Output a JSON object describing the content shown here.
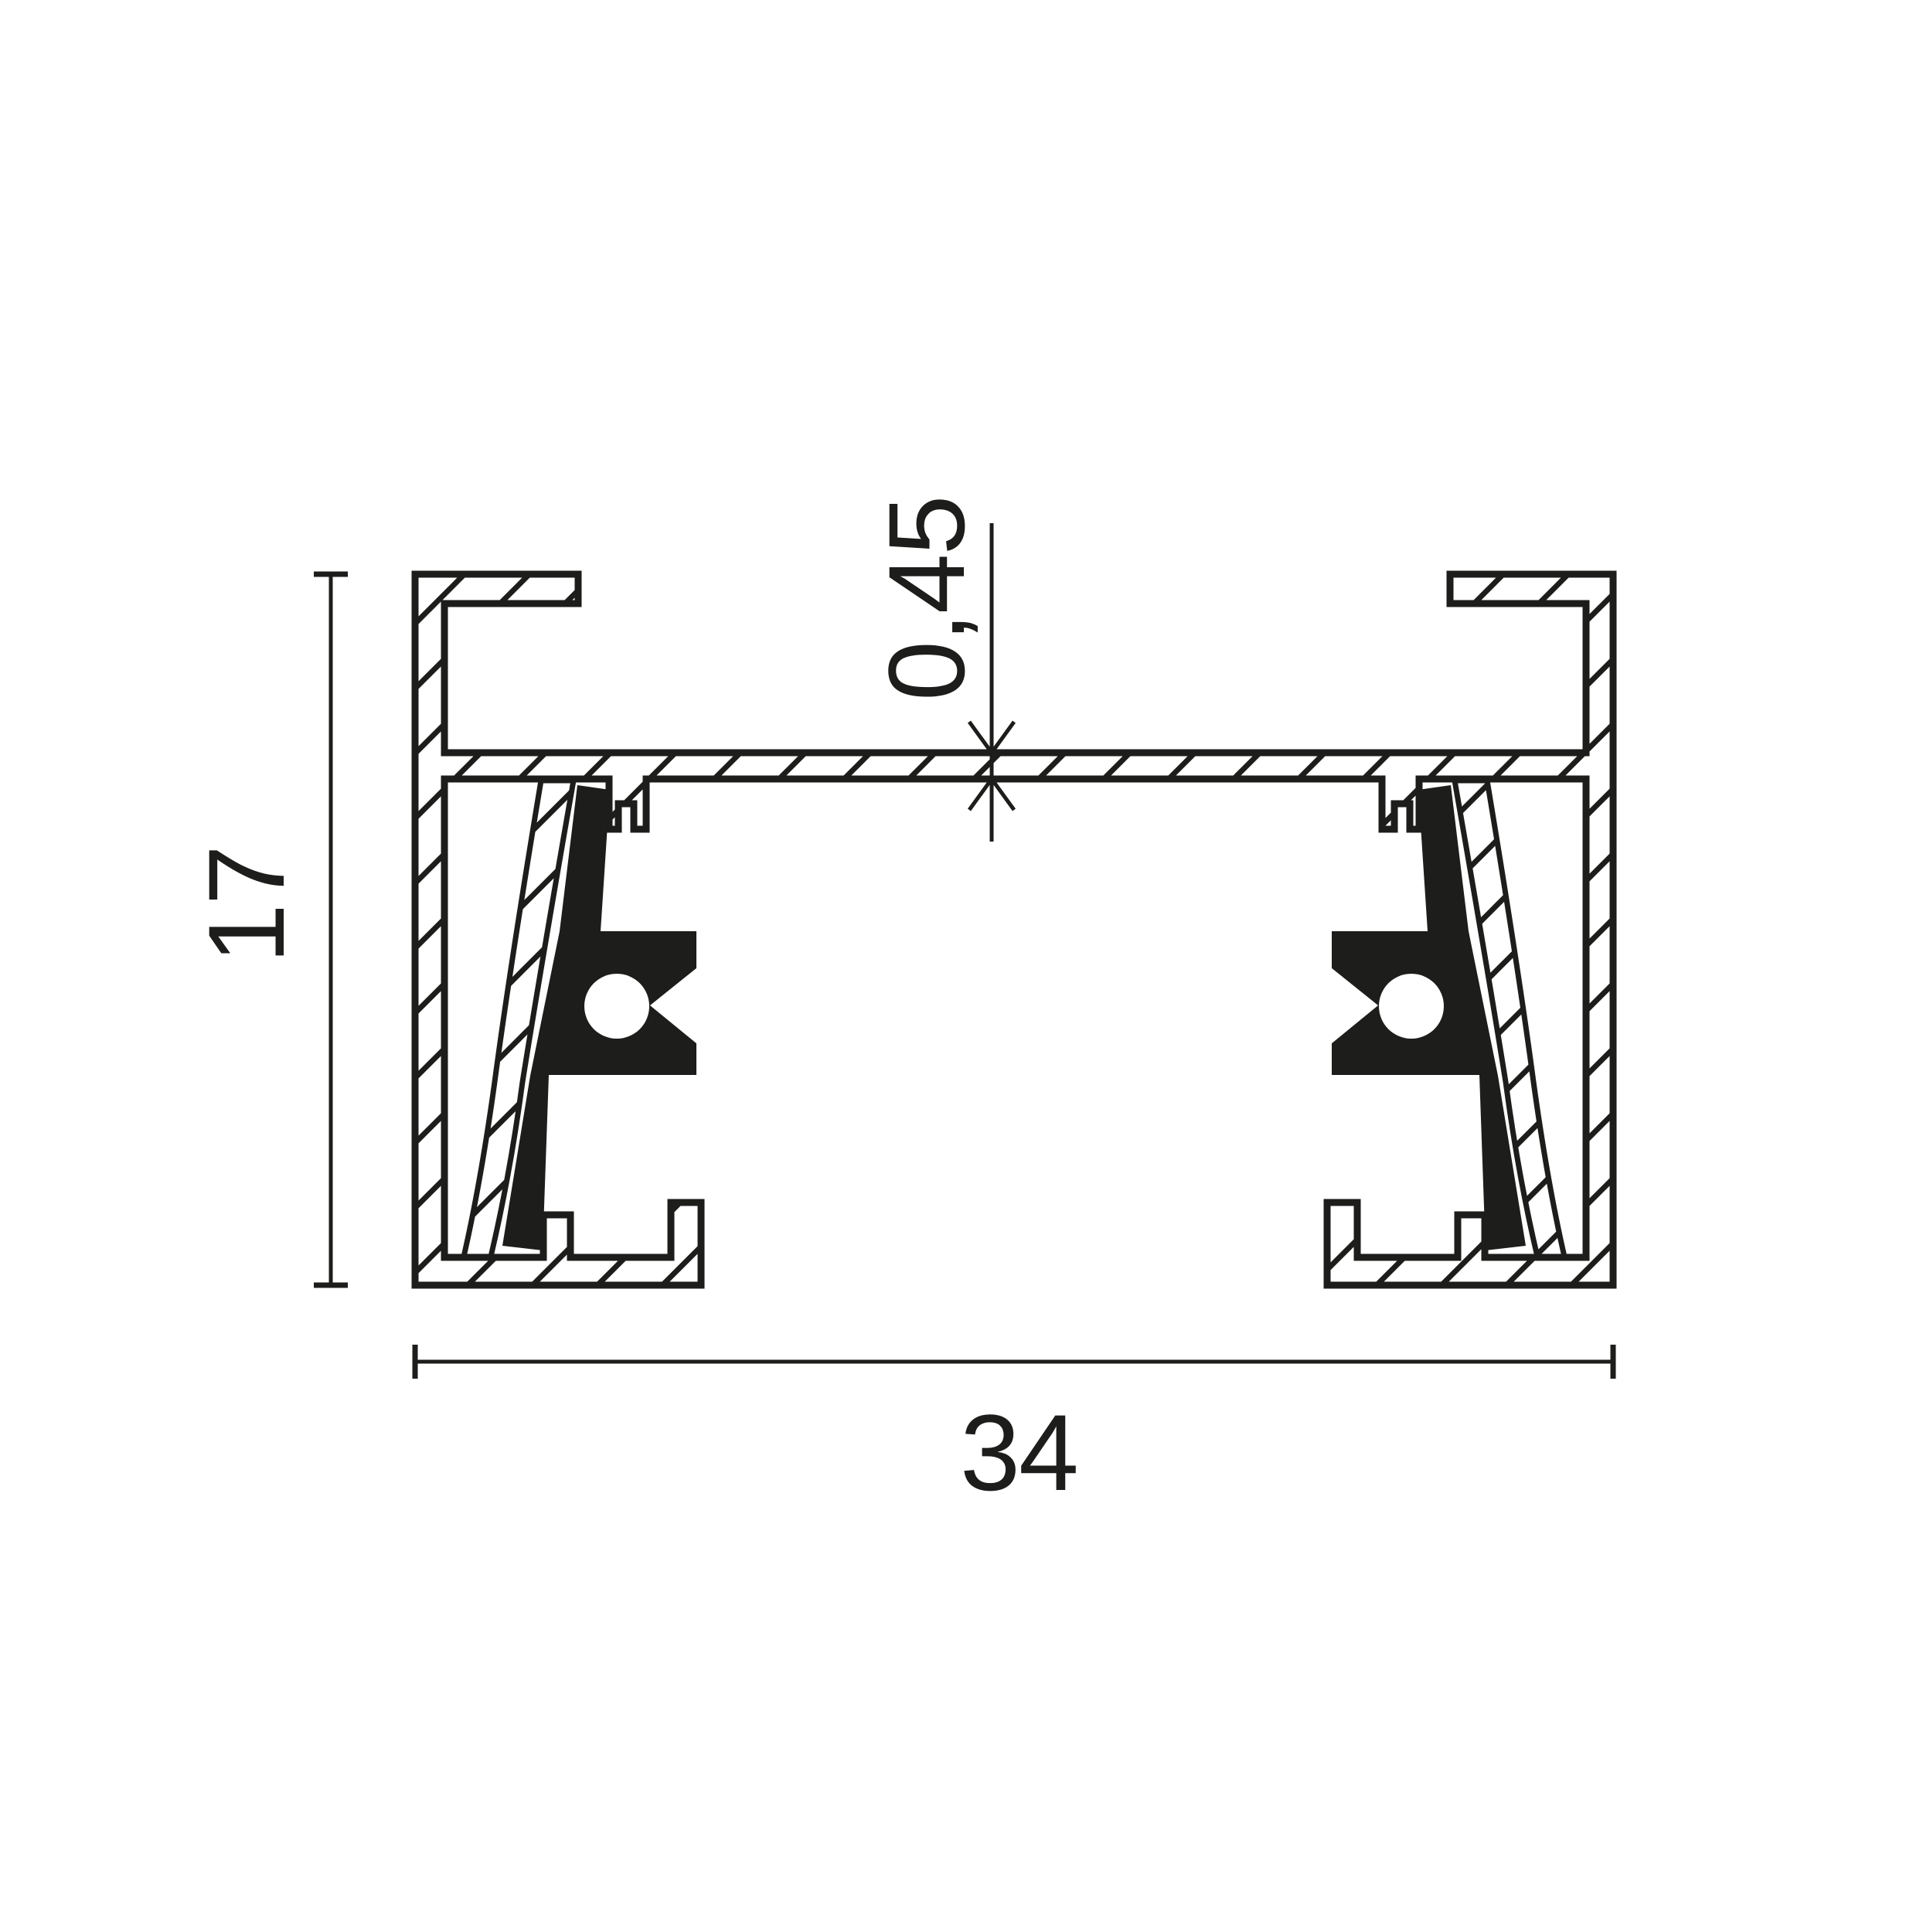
{
  "figure": {
    "type": "profile-cross-section",
    "description": "Technical sectional drawing of a mounting track profile with two conductor inserts",
    "dimensions": {
      "web_thickness": "0,45",
      "overall_height": "17",
      "overall_width": "34"
    },
    "colors": {
      "ink": "#1d1d1b",
      "background": "#ffffff"
    }
  }
}
